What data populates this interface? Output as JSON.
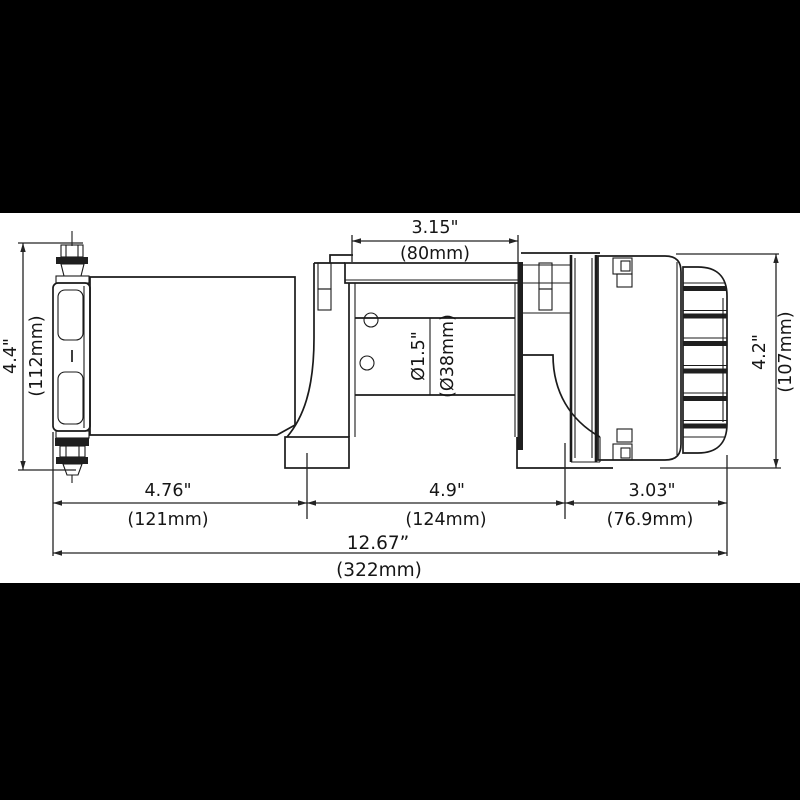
{
  "drawing": {
    "kind": "winch-dimensional-drawing",
    "colors": {
      "line": "#1b1b1b",
      "background": "#ffffff",
      "letterbox": "#000000"
    },
    "dims": {
      "top_in": "3.15\"",
      "top_mm": "(80mm)",
      "left_in": "4.4\"",
      "left_mm": "(112mm)",
      "right_in": "4.2\"",
      "right_mm": "(107mm)",
      "drum_in": "Ø1.5\"",
      "drum_mm": "(Ø38mm)",
      "seg1_in": "4.76\"",
      "seg1_mm": "(121mm)",
      "seg2_in": "4.9\"",
      "seg2_mm": "(124mm)",
      "seg3_in": "3.03\"",
      "seg3_mm": "(76.9mm)",
      "overall_in": "12.67”",
      "overall_mm": "(322mm)"
    }
  }
}
